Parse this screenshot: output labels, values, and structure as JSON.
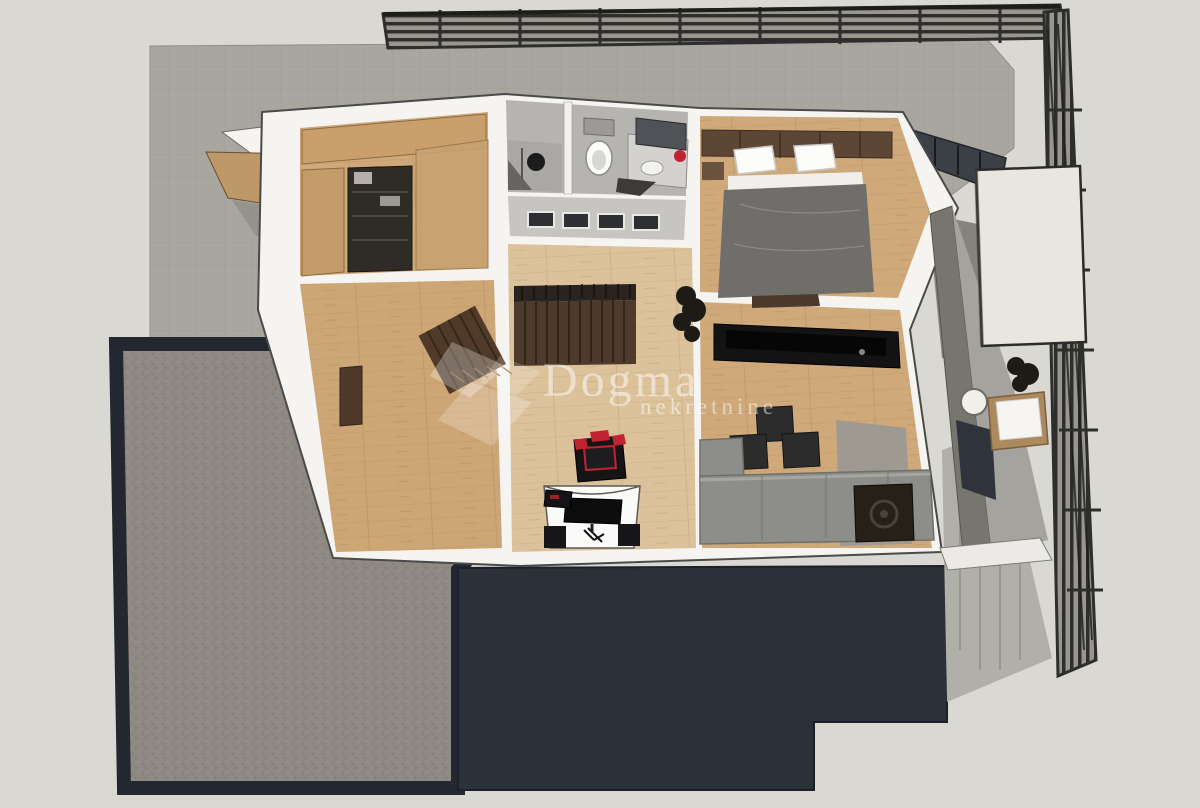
{
  "watermark": {
    "brand": "Dogma",
    "tagline": "nekretnine",
    "logo": "diamond-cube-logo"
  },
  "palette": {
    "background": "#d9d8d3",
    "roof_gray": "#a8a69f",
    "railing_dark": "#2e2e2c",
    "railing_slat": "#98968f",
    "terrace_frame": "#232830",
    "terrace_surface": "#8e8983",
    "lower_roof_navy": "#2b313a",
    "wall_white": "#f5f4f1",
    "wood_floor": "#cfa97a",
    "wood_hall": "#dcc29b",
    "wood_left": "#cda676",
    "bathroom_gray": "#b5b4b0",
    "stair_brown": "#4e3a2a",
    "headboard_brown": "#5d4634",
    "bed_duvet_gray": "#6f6e6a",
    "sofa_gray": "#8d8d8a",
    "tv_black": "#131313",
    "chair_red": "#bf2430",
    "slab_cream": "#e9e6df",
    "concrete_gray": "#77766e",
    "balcony_floor": "#a4a39d",
    "watermark_white": "#ffffff"
  }
}
